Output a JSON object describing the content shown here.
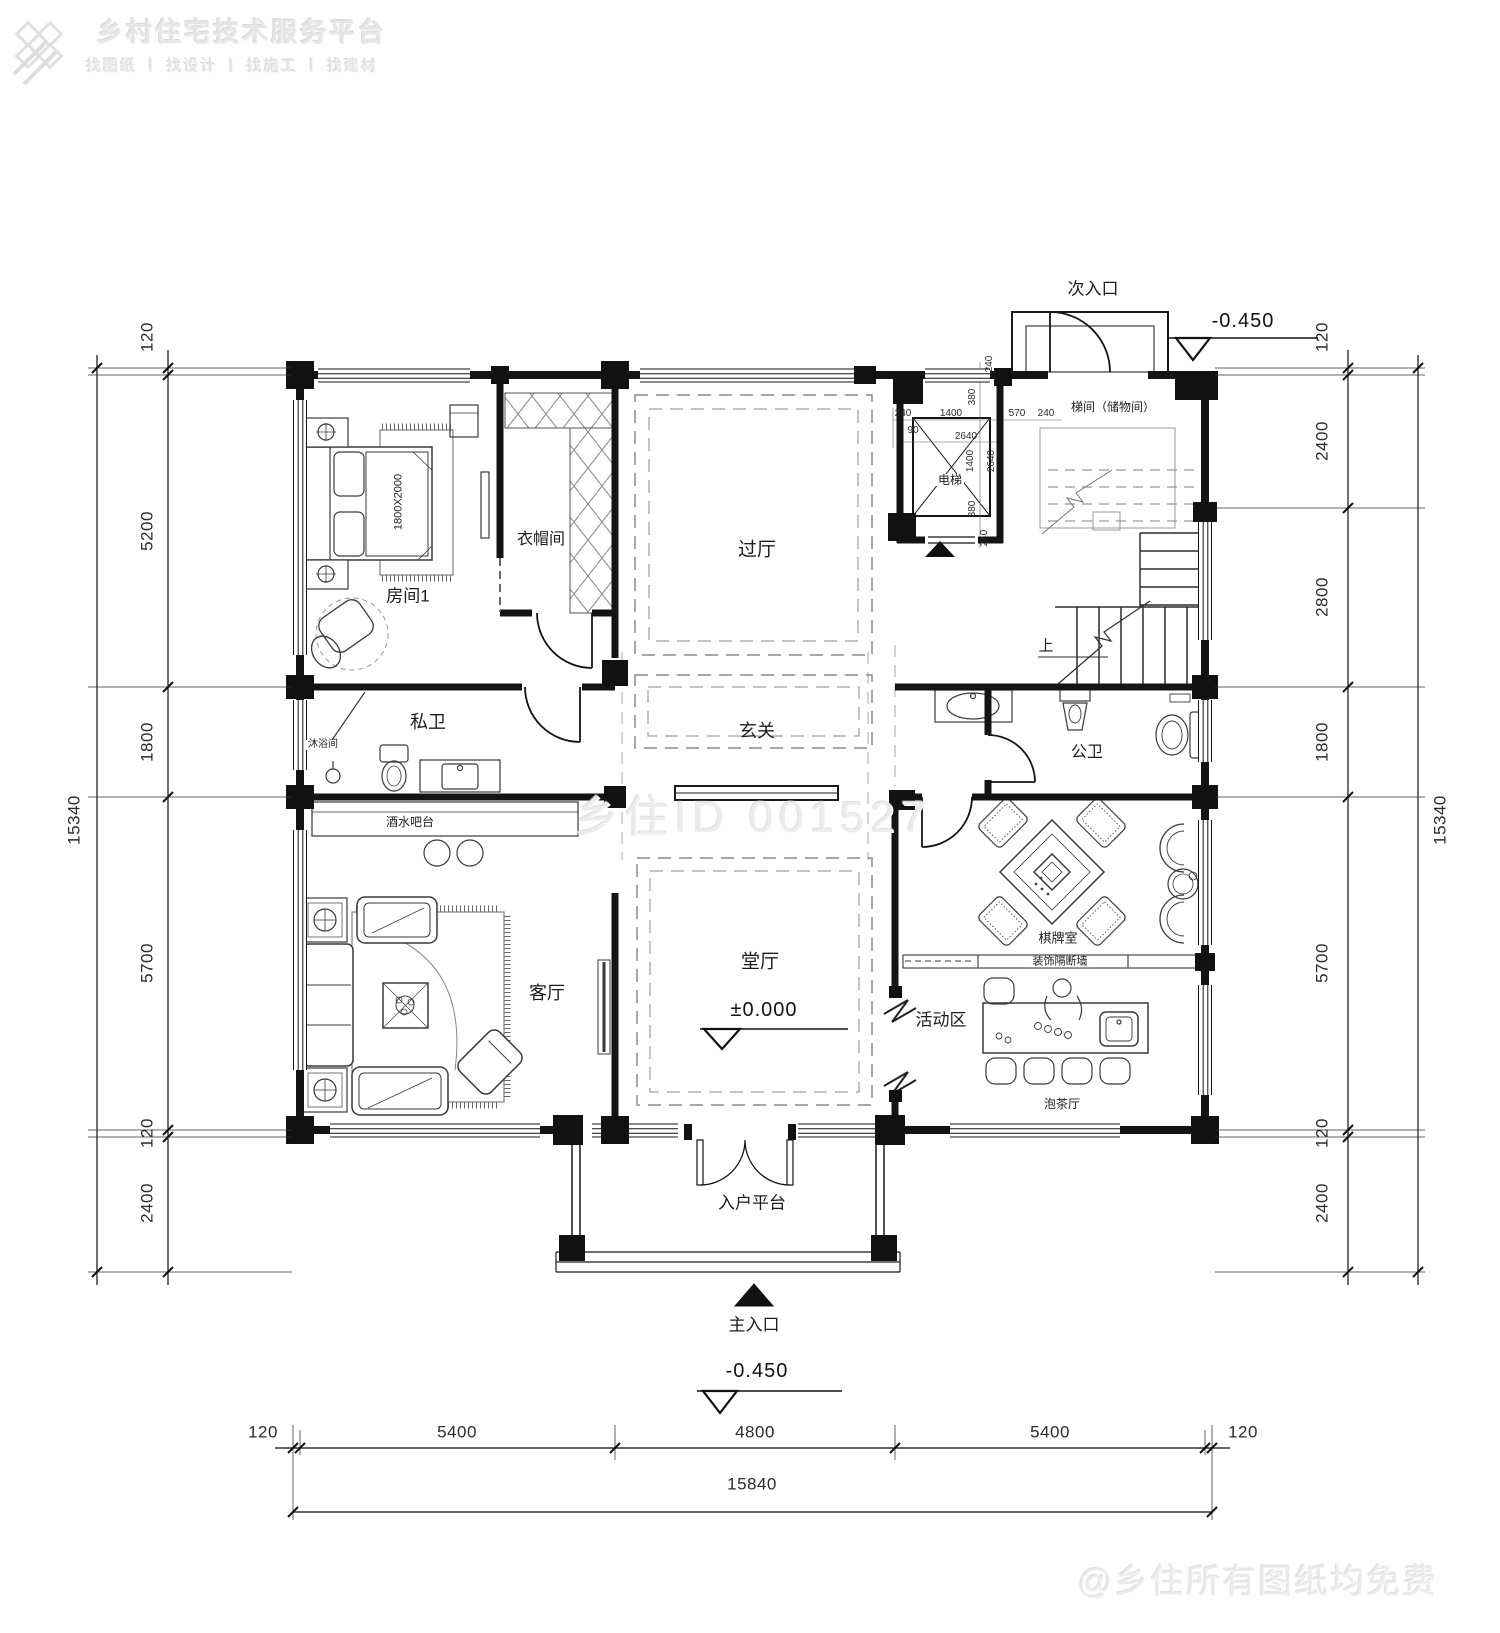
{
  "brand": {
    "title": "乡村住宅技术服务平台",
    "tagline": "找图纸 丨 找设计 丨 找施工 丨 找建材"
  },
  "watermarks": {
    "center": "乡住ID 001527",
    "corner": "@乡住所有图纸均免费"
  },
  "rooms": {
    "bedroom1": "房间1",
    "bed_size": "1800X2000",
    "cloakroom": "衣帽间",
    "hallway": "过厅",
    "elevator": "电梯",
    "stair_storage": "梯间（储物间）",
    "secondary_entrance": "次入口",
    "foyer": "玄关",
    "private_bath": "私卫",
    "shower": "沐浴间",
    "bar": "酒水吧台",
    "public_bath": "公卫",
    "living_room": "客厅",
    "main_hall": "堂厅",
    "mahjong_room": "棋牌室",
    "partition": "装饰隔断墙",
    "activity_area": "活动区",
    "tea_room": "泡茶厅",
    "entry_platform": "入户平台",
    "main_entrance": "主入口",
    "up": "上"
  },
  "levels": {
    "main_hall": "±0.000",
    "main_entrance": "-0.450",
    "secondary_entrance": "-0.450"
  },
  "dims": {
    "left": {
      "segments": [
        "120",
        "5200",
        "1800",
        "5700",
        "120",
        "2400"
      ],
      "total": "15340"
    },
    "right": {
      "segments": [
        "120",
        "2400",
        "2800",
        "1800",
        "5700",
        "120",
        "2400"
      ],
      "total": "15340"
    },
    "bottom": {
      "segments": [
        "120",
        "5400",
        "4800",
        "5400",
        "120"
      ],
      "total": "15840"
    },
    "shaft": [
      "240",
      "240",
      "1400",
      "380",
      "570",
      "240",
      "90",
      "2640",
      "1400",
      "2640",
      "380",
      "240"
    ]
  }
}
